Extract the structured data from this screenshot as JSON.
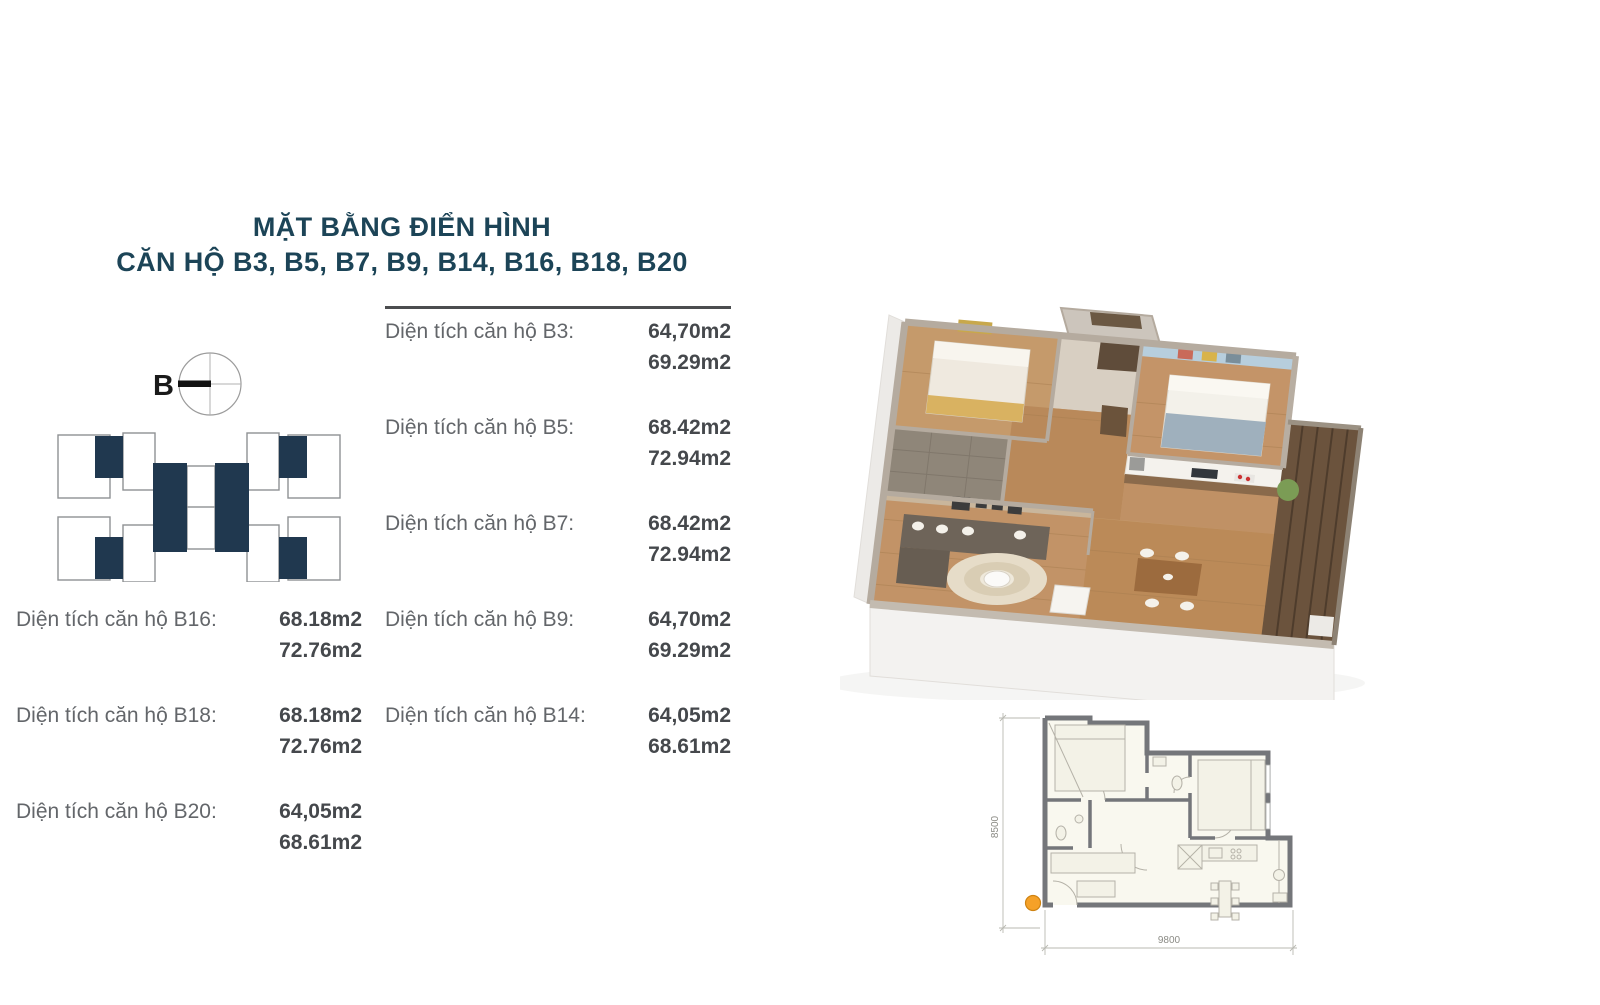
{
  "title": {
    "line1": "MẶT BẰNG ĐIỂN HÌNH",
    "line2": "CĂN HỘ B3, B5, B7, B9, B14, B16, B18, B20"
  },
  "key_plan": {
    "compass_label": "B"
  },
  "areas": {
    "middle": [
      {
        "label": "Diện tích căn hộ B3:",
        "value1": "64,70m2",
        "value2": "69.29m2"
      },
      {
        "label": "Diện tích căn hộ B5:",
        "value1": "68.42m2",
        "value2": "72.94m2"
      },
      {
        "label": "Diện tích căn hộ B7:",
        "value1": "68.42m2",
        "value2": "72.94m2"
      },
      {
        "label": "Diện tích căn hộ B9:",
        "value1": "64,70m2",
        "value2": "69.29m2"
      },
      {
        "label": "Diện tích căn hộ B14:",
        "value1": "64,05m2",
        "value2": "68.61m2"
      }
    ],
    "left": [
      {
        "label": "Diện tích căn hộ B16:",
        "value1": "68.18m2",
        "value2": "72.76m2"
      },
      {
        "label": "Diện tích căn hộ B18:",
        "value1": "68.18m2",
        "value2": "72.76m2"
      },
      {
        "label": "Diện tích căn hộ B20:",
        "value1": "64,05m2",
        "value2": "68.61m2"
      }
    ]
  },
  "floor_plan": {
    "dim_height": "8500",
    "dim_width": "9800"
  },
  "colors": {
    "accent_navy": "#1c4457",
    "unit_highlight": "#20384f",
    "marker_orange": "#f5a128"
  }
}
